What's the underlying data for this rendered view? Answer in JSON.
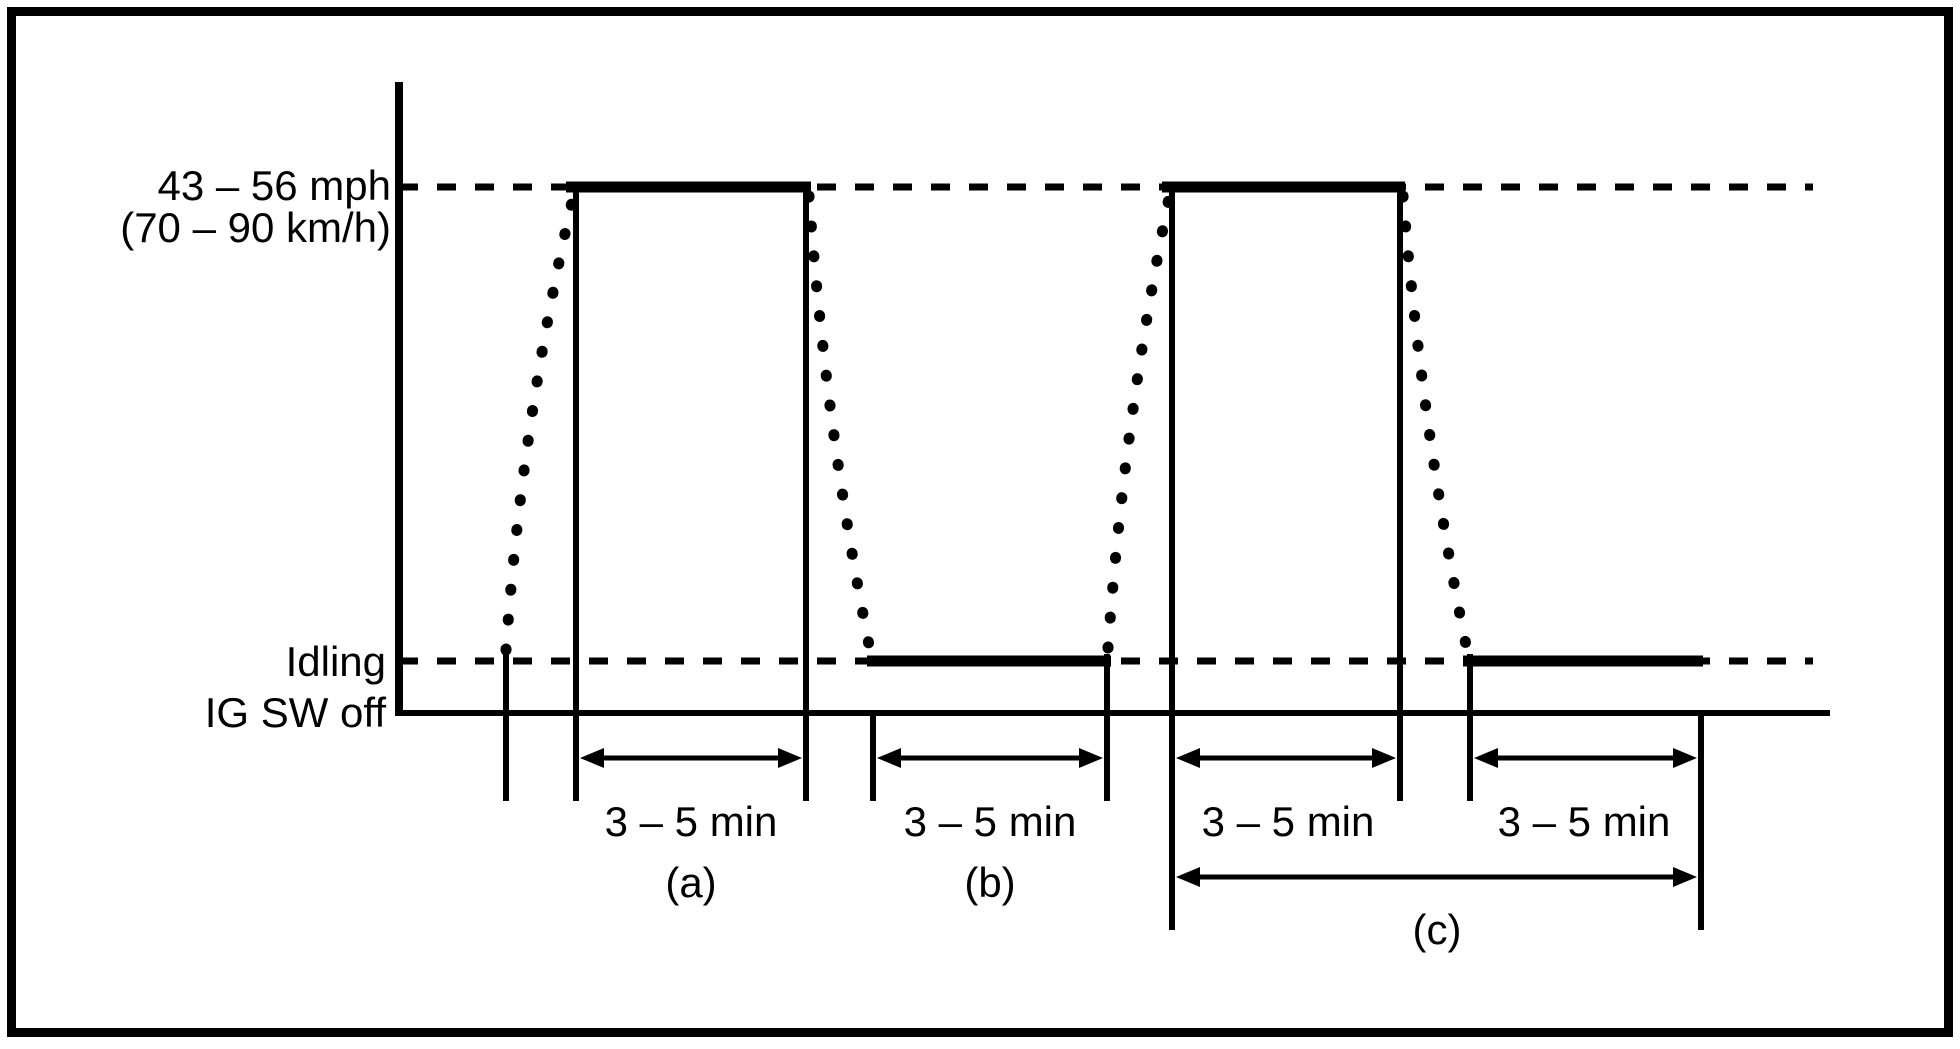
{
  "figure": {
    "type": "drive-pattern-timing-diagram",
    "background": "#ffffff",
    "line_color": "#000000"
  },
  "axis_labels": {
    "speed_line1": "43 – 56 mph",
    "speed_line2": "(70 – 90 km/h)",
    "idling": "Idling",
    "ig_sw_off": "IG SW off"
  },
  "intervals": {
    "a": {
      "duration": "3 – 5 min",
      "tag": "(a)"
    },
    "b": {
      "duration": "3 – 5 min",
      "tag": "(b)"
    },
    "c_first": {
      "duration": "3 – 5 min"
    },
    "c_second": {
      "duration": "3 – 5 min"
    },
    "c": {
      "tag": "(c)"
    }
  },
  "chart_data": {
    "type": "line",
    "title": "",
    "xlabel": "",
    "ylabel": "",
    "y_levels": [
      {
        "name": "IG SW off",
        "value": 0
      },
      {
        "name": "Idling",
        "value": 1
      },
      {
        "name": "43 – 56 mph (70 – 90 km/h)",
        "value": 2
      }
    ],
    "phases": [
      {
        "phase": "start",
        "level": "IG SW off",
        "style": "solid"
      },
      {
        "phase": "accelerate",
        "from": "IG SW off",
        "to": "43 – 56 mph (70 – 90 km/h)",
        "style": "dotted"
      },
      {
        "phase": "drive at 43 – 56 mph",
        "duration": "3 – 5 min",
        "interval": "(a)",
        "style": "solid"
      },
      {
        "phase": "decelerate",
        "from": "43 – 56 mph (70 – 90 km/h)",
        "to": "Idling",
        "style": "dotted"
      },
      {
        "phase": "idle",
        "duration": "3 – 5 min",
        "interval": "(b)",
        "style": "solid"
      },
      {
        "phase": "accelerate",
        "from": "Idling",
        "to": "43 – 56 mph (70 – 90 km/h)",
        "style": "dotted"
      },
      {
        "phase": "drive at 43 – 56 mph",
        "duration": "3 – 5 min",
        "interval": "(c) first half",
        "style": "solid"
      },
      {
        "phase": "decelerate",
        "from": "43 – 56 mph (70 – 90 km/h)",
        "to": "Idling",
        "style": "dotted"
      },
      {
        "phase": "idle",
        "duration": "3 – 5 min",
        "interval": "(c) second half",
        "style": "solid"
      }
    ],
    "legend_position": "none",
    "grid": false
  }
}
